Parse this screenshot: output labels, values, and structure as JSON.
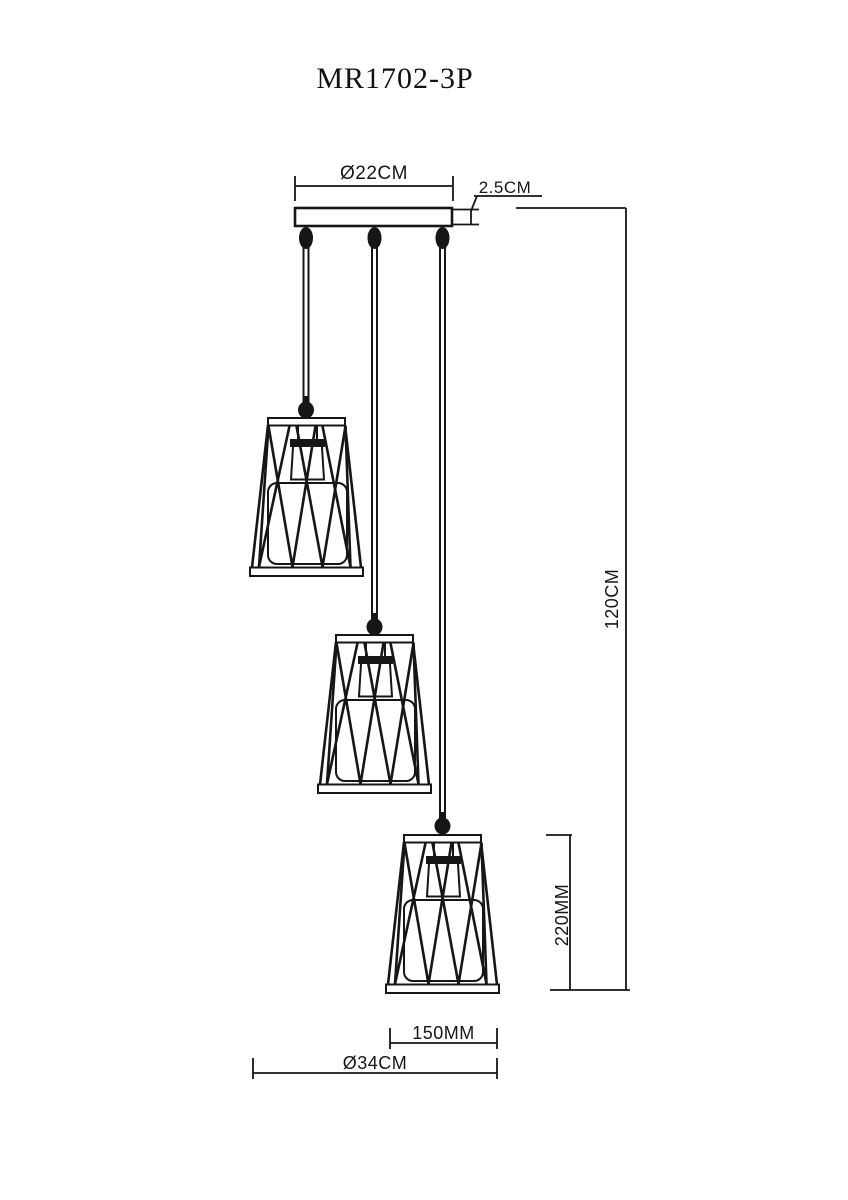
{
  "title": "MR1702-3P",
  "dimensions": {
    "canopy_diameter": "Ø22CM",
    "canopy_thickness": "2.5CM",
    "total_height": "120CM",
    "shade_height": "220MM",
    "shade_bottom_width": "150MM",
    "overall_diameter": "Ø34CM"
  },
  "drawing": {
    "lamp_count": 3,
    "stroke_color": "#161616",
    "background_color": "#ffffff"
  }
}
